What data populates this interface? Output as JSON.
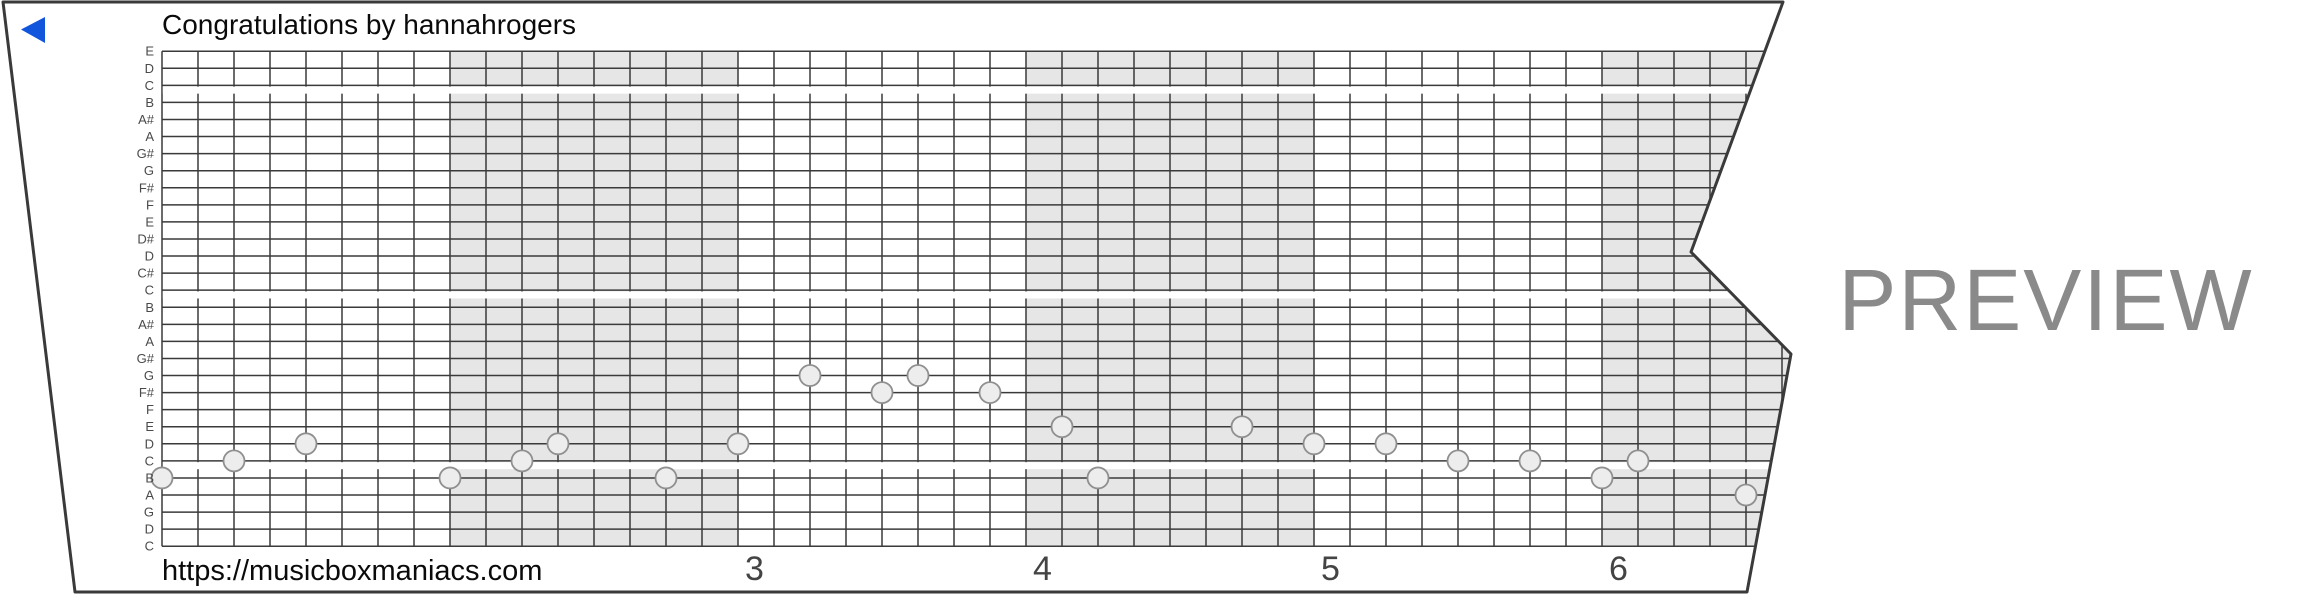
{
  "title": "Congratulations by hannahrogers",
  "watermark": "PREVIEW",
  "footer_url": "https://musicboxmaniacs.com",
  "back_icon_color": "#1155dd",
  "colors": {
    "grid_line": "#3a3a3a",
    "strip_border": "#3a3a3a",
    "strip_fill": "#ffffff",
    "measure_band": "#e6e6e6",
    "note_fill": "#ededed",
    "note_stroke": "#8f8f8f",
    "row_label": "#4a4a4a",
    "measure_number": "#444444",
    "watermark": "#8a8a8a"
  },
  "note_rows": [
    "E",
    "D",
    "C",
    "B",
    "A#",
    "A",
    "G#",
    "G",
    "F#",
    "F",
    "E",
    "D#",
    "D",
    "C#",
    "C",
    "B",
    "A#",
    "A",
    "G#",
    "G",
    "F#",
    "F",
    "E",
    "D",
    "C",
    "B",
    "A",
    "G",
    "D",
    "C"
  ],
  "octave_gap_after_rows": [
    3,
    15,
    25
  ],
  "measure_numbers": [
    {
      "label": "3",
      "beat": 16
    },
    {
      "label": "4",
      "beat": 24
    },
    {
      "label": "5",
      "beat": 32
    },
    {
      "label": "6",
      "beat": 40
    }
  ],
  "shaded_measures_beats": [
    [
      8,
      16
    ],
    [
      24,
      32
    ],
    [
      40,
      49
    ]
  ],
  "beats_per_measure": 8,
  "notes": [
    {
      "beat": 0,
      "row": 26,
      "note": "B"
    },
    {
      "beat": 2,
      "row": 25,
      "note": "C"
    },
    {
      "beat": 4,
      "row": 24,
      "note": "D"
    },
    {
      "beat": 8,
      "row": 26,
      "note": "B"
    },
    {
      "beat": 10,
      "row": 25,
      "note": "C"
    },
    {
      "beat": 11,
      "row": 24,
      "note": "D"
    },
    {
      "beat": 14,
      "row": 26,
      "note": "B"
    },
    {
      "beat": 16,
      "row": 24,
      "note": "D"
    },
    {
      "beat": 18,
      "row": 20,
      "note": "G"
    },
    {
      "beat": 20,
      "row": 21,
      "note": "F#"
    },
    {
      "beat": 21,
      "row": 20,
      "note": "G"
    },
    {
      "beat": 23,
      "row": 21,
      "note": "F#"
    },
    {
      "beat": 25,
      "row": 23,
      "note": "E"
    },
    {
      "beat": 26,
      "row": 26,
      "note": "B"
    },
    {
      "beat": 30,
      "row": 23,
      "note": "E"
    },
    {
      "beat": 32,
      "row": 24,
      "note": "D"
    },
    {
      "beat": 34,
      "row": 24,
      "note": "D"
    },
    {
      "beat": 36,
      "row": 25,
      "note": "C"
    },
    {
      "beat": 38,
      "row": 25,
      "note": "C"
    },
    {
      "beat": 40,
      "row": 26,
      "note": "B"
    },
    {
      "beat": 41,
      "row": 25,
      "note": "C"
    },
    {
      "beat": 44,
      "row": 27,
      "note": "A"
    }
  ]
}
